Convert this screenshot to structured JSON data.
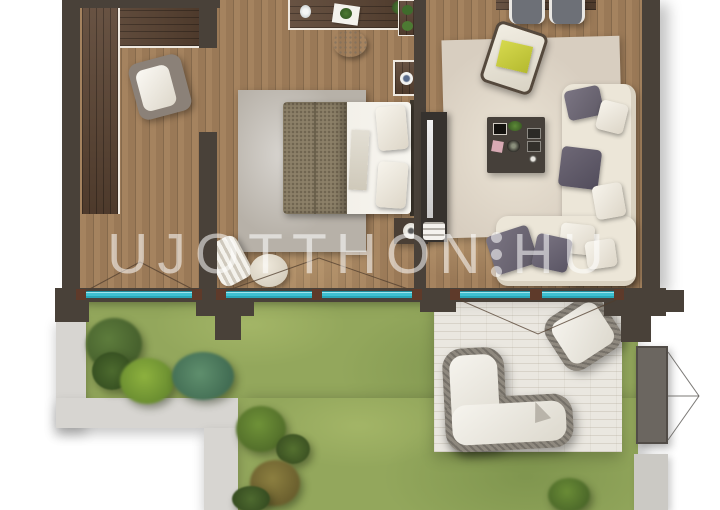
{
  "watermark": {
    "text_left": "UJOTTHON",
    "text_right": "HU",
    "separator": "vertical-three-dots",
    "color": "#ffffff",
    "opacity": 0.55
  },
  "palette": {
    "background": "#ffffff",
    "wall": "#494139",
    "floor_wood": "#9a7957",
    "dark_wood_furniture": "#5b4433",
    "window_glass": "#3fc1d1",
    "window_frame_marker": "#5e3a2a",
    "grass": "#93a75c",
    "stone_path": "#d7d5d1",
    "terrace_stone": "#eae7e0",
    "bedroom_rug": "#b7b1a8",
    "living_rug": "#d8cec0",
    "sofa_cream": "#ece6d8",
    "pillow_gray_purple": "#6b6673",
    "accent_yellow_cushion": "#c9cc42",
    "bed_blanket_taupe": "#8c8068",
    "gate_gray": "#6b6660"
  },
  "plan": {
    "view": "top-down apartment floor plan render with private garden",
    "interior": {
      "hall": [
        "l-shaped-wardrobe",
        "accent-armchair"
      ],
      "bedroom": [
        "desk-with-plants",
        "round-pouf",
        "gray-area-rug",
        "double-bed",
        "taupe-blanket",
        "white-duvet-and-pillows",
        "nightstand-with-lamp",
        "side-table-with-cup",
        "wall-shelf-with-plants",
        "laundry-basket",
        "floor-cushion"
      ],
      "living_room": [
        "dining-table",
        "two-gray-chairs",
        "tilted-armchair-with-yellow-cushion",
        "beige-area-rug",
        "l-shaped-cream-sofa",
        "gray-throw-pillows",
        "square-coffee-table",
        "tv-media-wall"
      ]
    },
    "exterior": {
      "garden": [
        "lawn",
        "shrubs",
        "palm-plants",
        "l-shaped-stone-path",
        "side-gate",
        "fence-segment"
      ],
      "terrace": [
        "stone-terrace",
        "outdoor-l-sofa",
        "outdoor-lounge-chair"
      ]
    },
    "features": [
      "teal-glazed-windows",
      "french-door-swing-arcs",
      "wall-piers"
    ]
  }
}
